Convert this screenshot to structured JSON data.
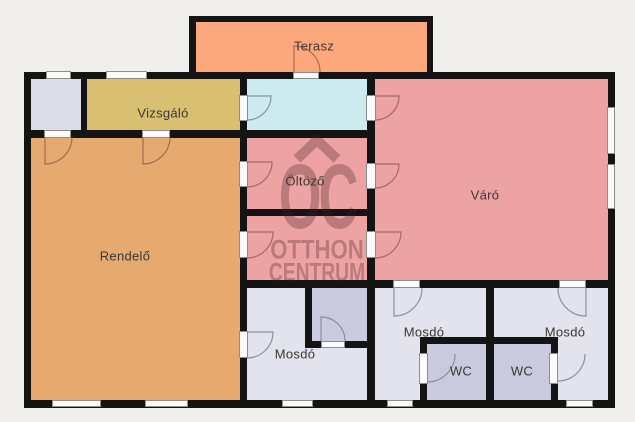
{
  "rooms": {
    "terasz": {
      "label": "Terasz"
    },
    "vizsgalo": {
      "label": "Vizsgáló"
    },
    "rendelo": {
      "label": "Rendelő"
    },
    "oltozo": {
      "label": "Öltöző"
    },
    "varo": {
      "label": "Váró"
    },
    "mosdo_kozep": {
      "label": "Mosdó"
    },
    "mosdo_bal": {
      "label": "Mosdó"
    },
    "mosdo_jobb": {
      "label": "Mosdó"
    },
    "wc_bal": {
      "label": "WC"
    },
    "wc_jobb": {
      "label": "WC"
    }
  },
  "watermark": {
    "monogram": "OC",
    "line1": "OTTHON",
    "line2": "CENTRUM",
    "color": "rgba(75,30,35,0.31)"
  },
  "colors": {
    "background": "#f0efec",
    "walls": "#141414",
    "terasz": "#fda87c",
    "vizsgalo": "#d8bf72",
    "rendelo": "#e6aa70",
    "hall": "#cdeaee",
    "pink": "#eda3a3",
    "entry": "#dcdde6",
    "mosdo": "#e2e3ed",
    "wc": "#c9cade"
  }
}
